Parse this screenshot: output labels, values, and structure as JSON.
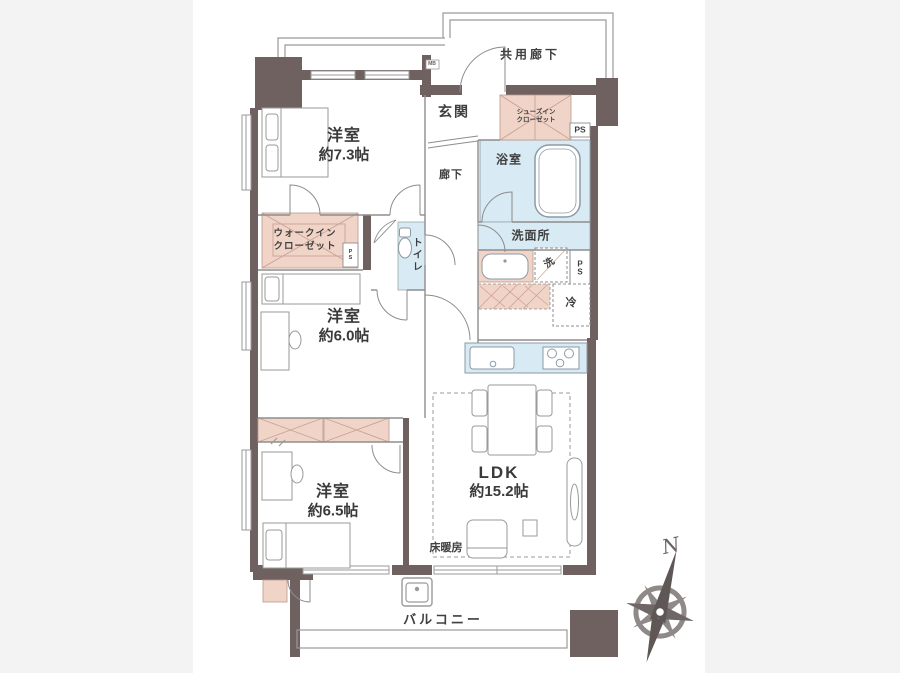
{
  "floorplan": {
    "rooms": {
      "western_7_3": {
        "name": "洋室",
        "size": "約7.3帖"
      },
      "western_6_0": {
        "name": "洋室",
        "size": "約6.0帖"
      },
      "western_6_5": {
        "name": "洋室",
        "size": "約6.5帖"
      },
      "ldk": {
        "name": "LDK",
        "size": "約15.2帖"
      }
    },
    "labels": {
      "common_corridor": "共用廊下",
      "entrance": "玄関",
      "shoes_closet_line1": "シューズイン",
      "shoes_closet_line2": "クローゼット",
      "ps_top": "PS",
      "mb": "MB",
      "bathroom": "浴室",
      "hallway": "廊下",
      "washroom": "洗面所",
      "laundry": "洗",
      "ps_p": "P",
      "ps_s": "S",
      "fridge": "冷",
      "toilet": "トイレ",
      "wic_line1": "ウォークイン",
      "wic_line2": "クローゼット",
      "floor_heating": "床暖房",
      "balcony": "バルコニー",
      "compass_north": "N"
    },
    "colors": {
      "wall": "#6e615f",
      "closet_pink": "#f0d4c8",
      "wet_area_blue": "#d8eaf4",
      "background_gray": "#f2f3f2",
      "line_gray": "#8d8d8d",
      "text": "#3f3f3f"
    }
  }
}
